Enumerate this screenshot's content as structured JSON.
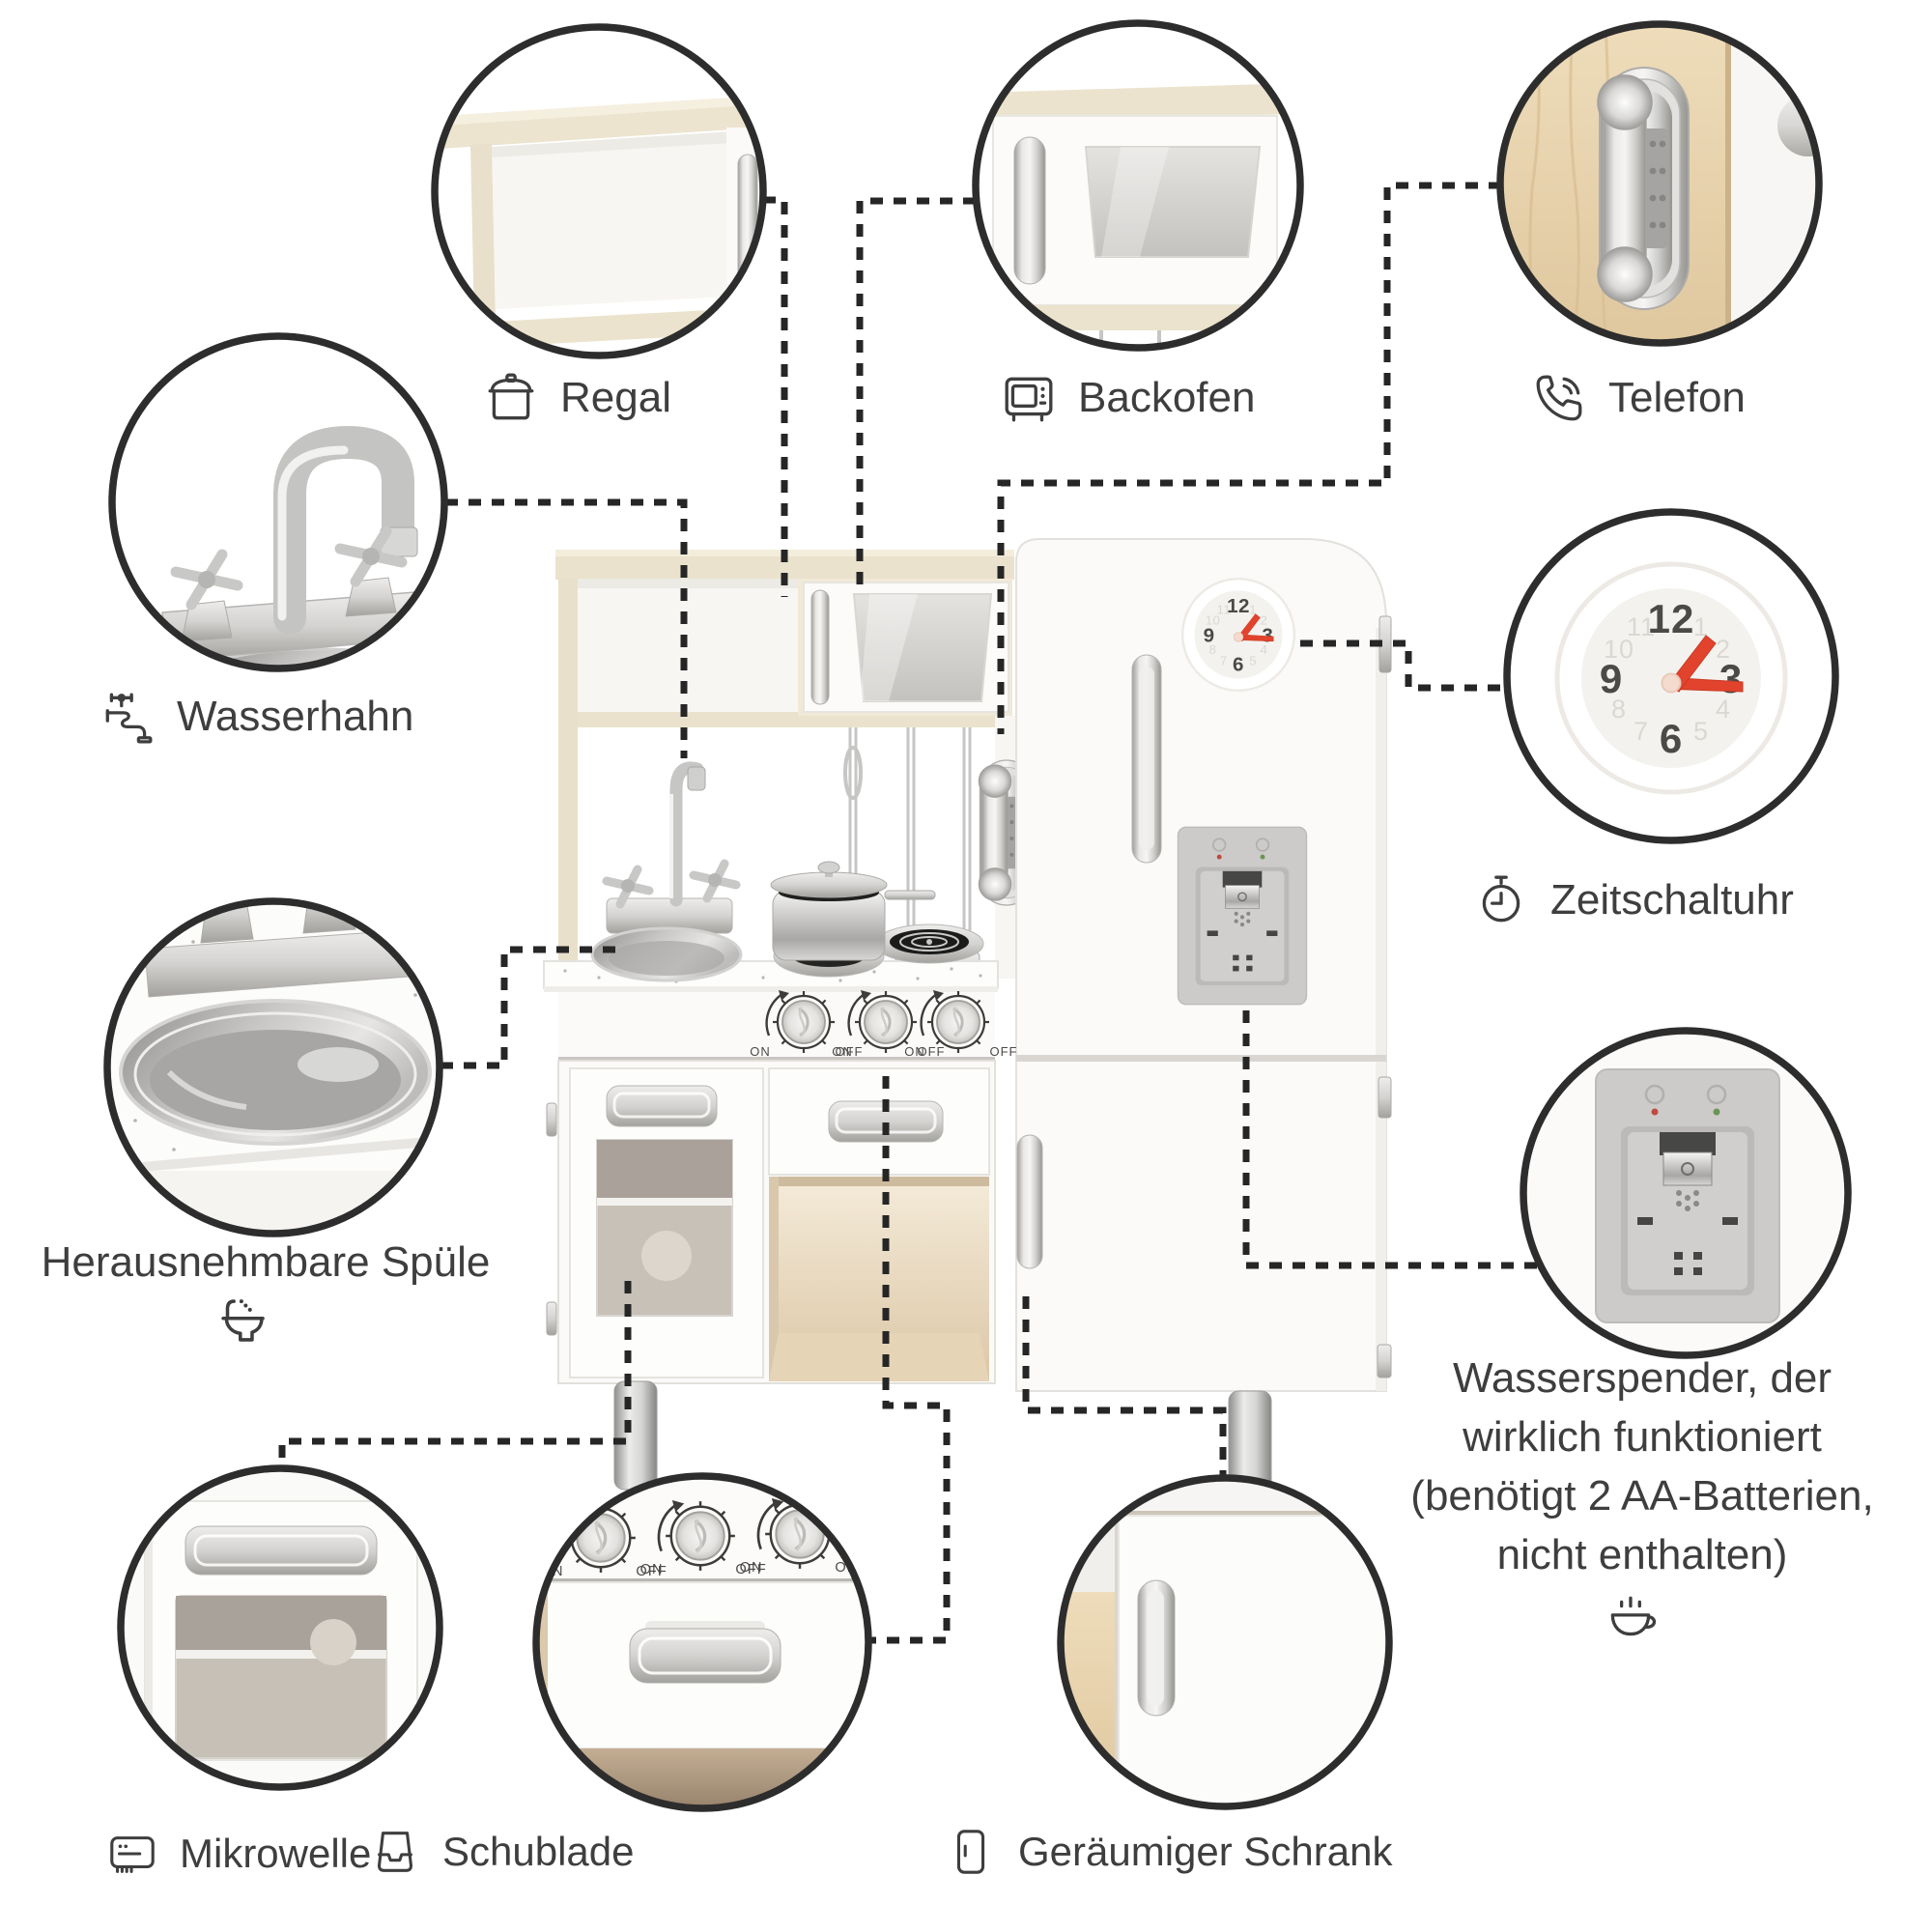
{
  "callouts": {
    "regal": {
      "label": "Regal",
      "icon": "pot-icon"
    },
    "backofen": {
      "label": "Backofen",
      "icon": "oven-icon"
    },
    "telefon": {
      "label": "Telefon",
      "icon": "phone-call-icon"
    },
    "wasserhahn": {
      "label": "Wasserhahn",
      "icon": "faucet-icon"
    },
    "zeitschaltuhr": {
      "label": "Zeitschaltuhr",
      "icon": "stopwatch-icon"
    },
    "herausnehmbare_spuele": {
      "label": "Herausnehmbare Spüle",
      "icon": "sink-basin-icon"
    },
    "wasserspender": {
      "lines": [
        "Wasserspender, der",
        "wirklich funktioniert",
        "(benötigt 2 AA-Batterien,",
        "nicht enthalten)"
      ],
      "icon": "coffee-cup-icon"
    },
    "mikrowelle": {
      "label": "Mikrowelle",
      "icon": "microwave-icon"
    },
    "schublade": {
      "label": "Schublade",
      "icon": "drawer-icon"
    },
    "geraeumiger_schrank": {
      "label": "Geräumiger Schrank",
      "icon": "door-icon"
    }
  },
  "kitchen": {
    "knob_on": "ON",
    "knob_off": "OFF"
  },
  "clock": {
    "main": [
      "12",
      "3",
      "6",
      "9"
    ],
    "faint": [
      "1",
      "2",
      "4",
      "5",
      "7",
      "8",
      "10",
      "11"
    ]
  },
  "colors": {
    "outline": "#2d2d2d",
    "text": "#3e3e3e",
    "clock_hands_red": "#e2432c",
    "cream_wood": "#ebe3cd",
    "light_wood": "#e9d4ae",
    "silver": "#c9c9c7"
  }
}
